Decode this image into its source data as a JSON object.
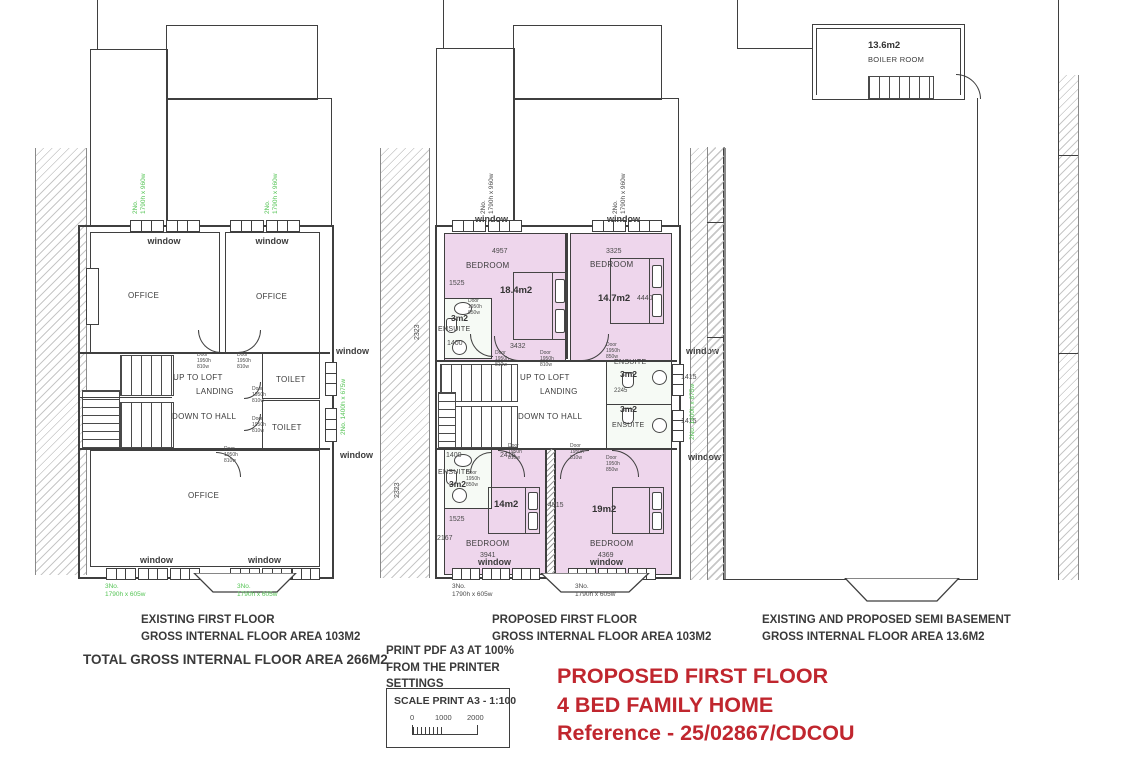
{
  "colors": {
    "bedroom_pink": "#eed6ec",
    "ensuite_fill": "#f6faf5",
    "spec_green": "#55c455",
    "title_red": "#c0262e"
  },
  "labels": {
    "window": "window",
    "office": "OFFICE",
    "bedroom": "BEDROOM",
    "ensuite": "ENSUITE",
    "toilet": "TOILET",
    "up_to_loft": "UP TO LOFT",
    "landing": "LANDING",
    "down_to_hall": "DOWN TO HALL",
    "boiler_room": "BOILER ROOM",
    "door_810": "Door 1950h 810w",
    "door_850": "Door 1950h 850w"
  },
  "areas": {
    "bedroom1": "18.4m2",
    "bedroom2": "14.7m2",
    "bedroom3": "14m2",
    "bedroom4": "19m2",
    "ensuite": "3m2",
    "boiler": "13.6m2"
  },
  "window_specs": {
    "top": {
      "count": "2No.",
      "size": "1790h x 960w"
    },
    "side": {
      "count": "2No.",
      "size": "1400h x 675w"
    },
    "bottom": {
      "count": "3No.",
      "size": "1790h x 605w"
    }
  },
  "dims": {
    "b1_top": "4957",
    "b1_left": "1525",
    "b1_ens": "1400",
    "b1_bottom": "3432",
    "b1_side": "2323",
    "b2_top": "3325",
    "b2_side": "4440",
    "right_top": "1415",
    "right_bottom": "1415",
    "mid": "2245",
    "b3_top": "2416",
    "b3_ens": "1400",
    "b3_left": "1525",
    "b3_side": "2167",
    "b3_side2": "2323",
    "b3_bottom": "3941",
    "b4_mid": "4515",
    "b4_bottom": "4369"
  },
  "captions": {
    "existing": {
      "line1": "EXISTING FIRST FLOOR",
      "line2": "GROSS INTERNAL FLOOR AREA 103M2"
    },
    "proposed": {
      "line1": "PROPOSED FIRST FLOOR",
      "line2": "GROSS INTERNAL FLOOR AREA 103M2"
    },
    "basement": {
      "line1": "EXISTING AND PROPOSED SEMI BASEMENT",
      "line2": "GROSS INTERNAL FLOOR AREA 13.6M2"
    },
    "total": "TOTAL GROSS INTERNAL FLOOR AREA 266M2"
  },
  "print_note": {
    "line1": "PRINT PDF A3 AT 100%",
    "line2": "FROM THE PRINTER",
    "line3": "SETTINGS"
  },
  "scale_box": {
    "title": "SCALE PRINT A3 - 1:100",
    "t0": "0",
    "t1": "1000",
    "t2": "2000"
  },
  "title_block": {
    "line1": "PROPOSED FIRST FLOOR",
    "line2": "4 BED FAMILY HOME",
    "line3": "Reference - 25/02867/CDCOU"
  }
}
